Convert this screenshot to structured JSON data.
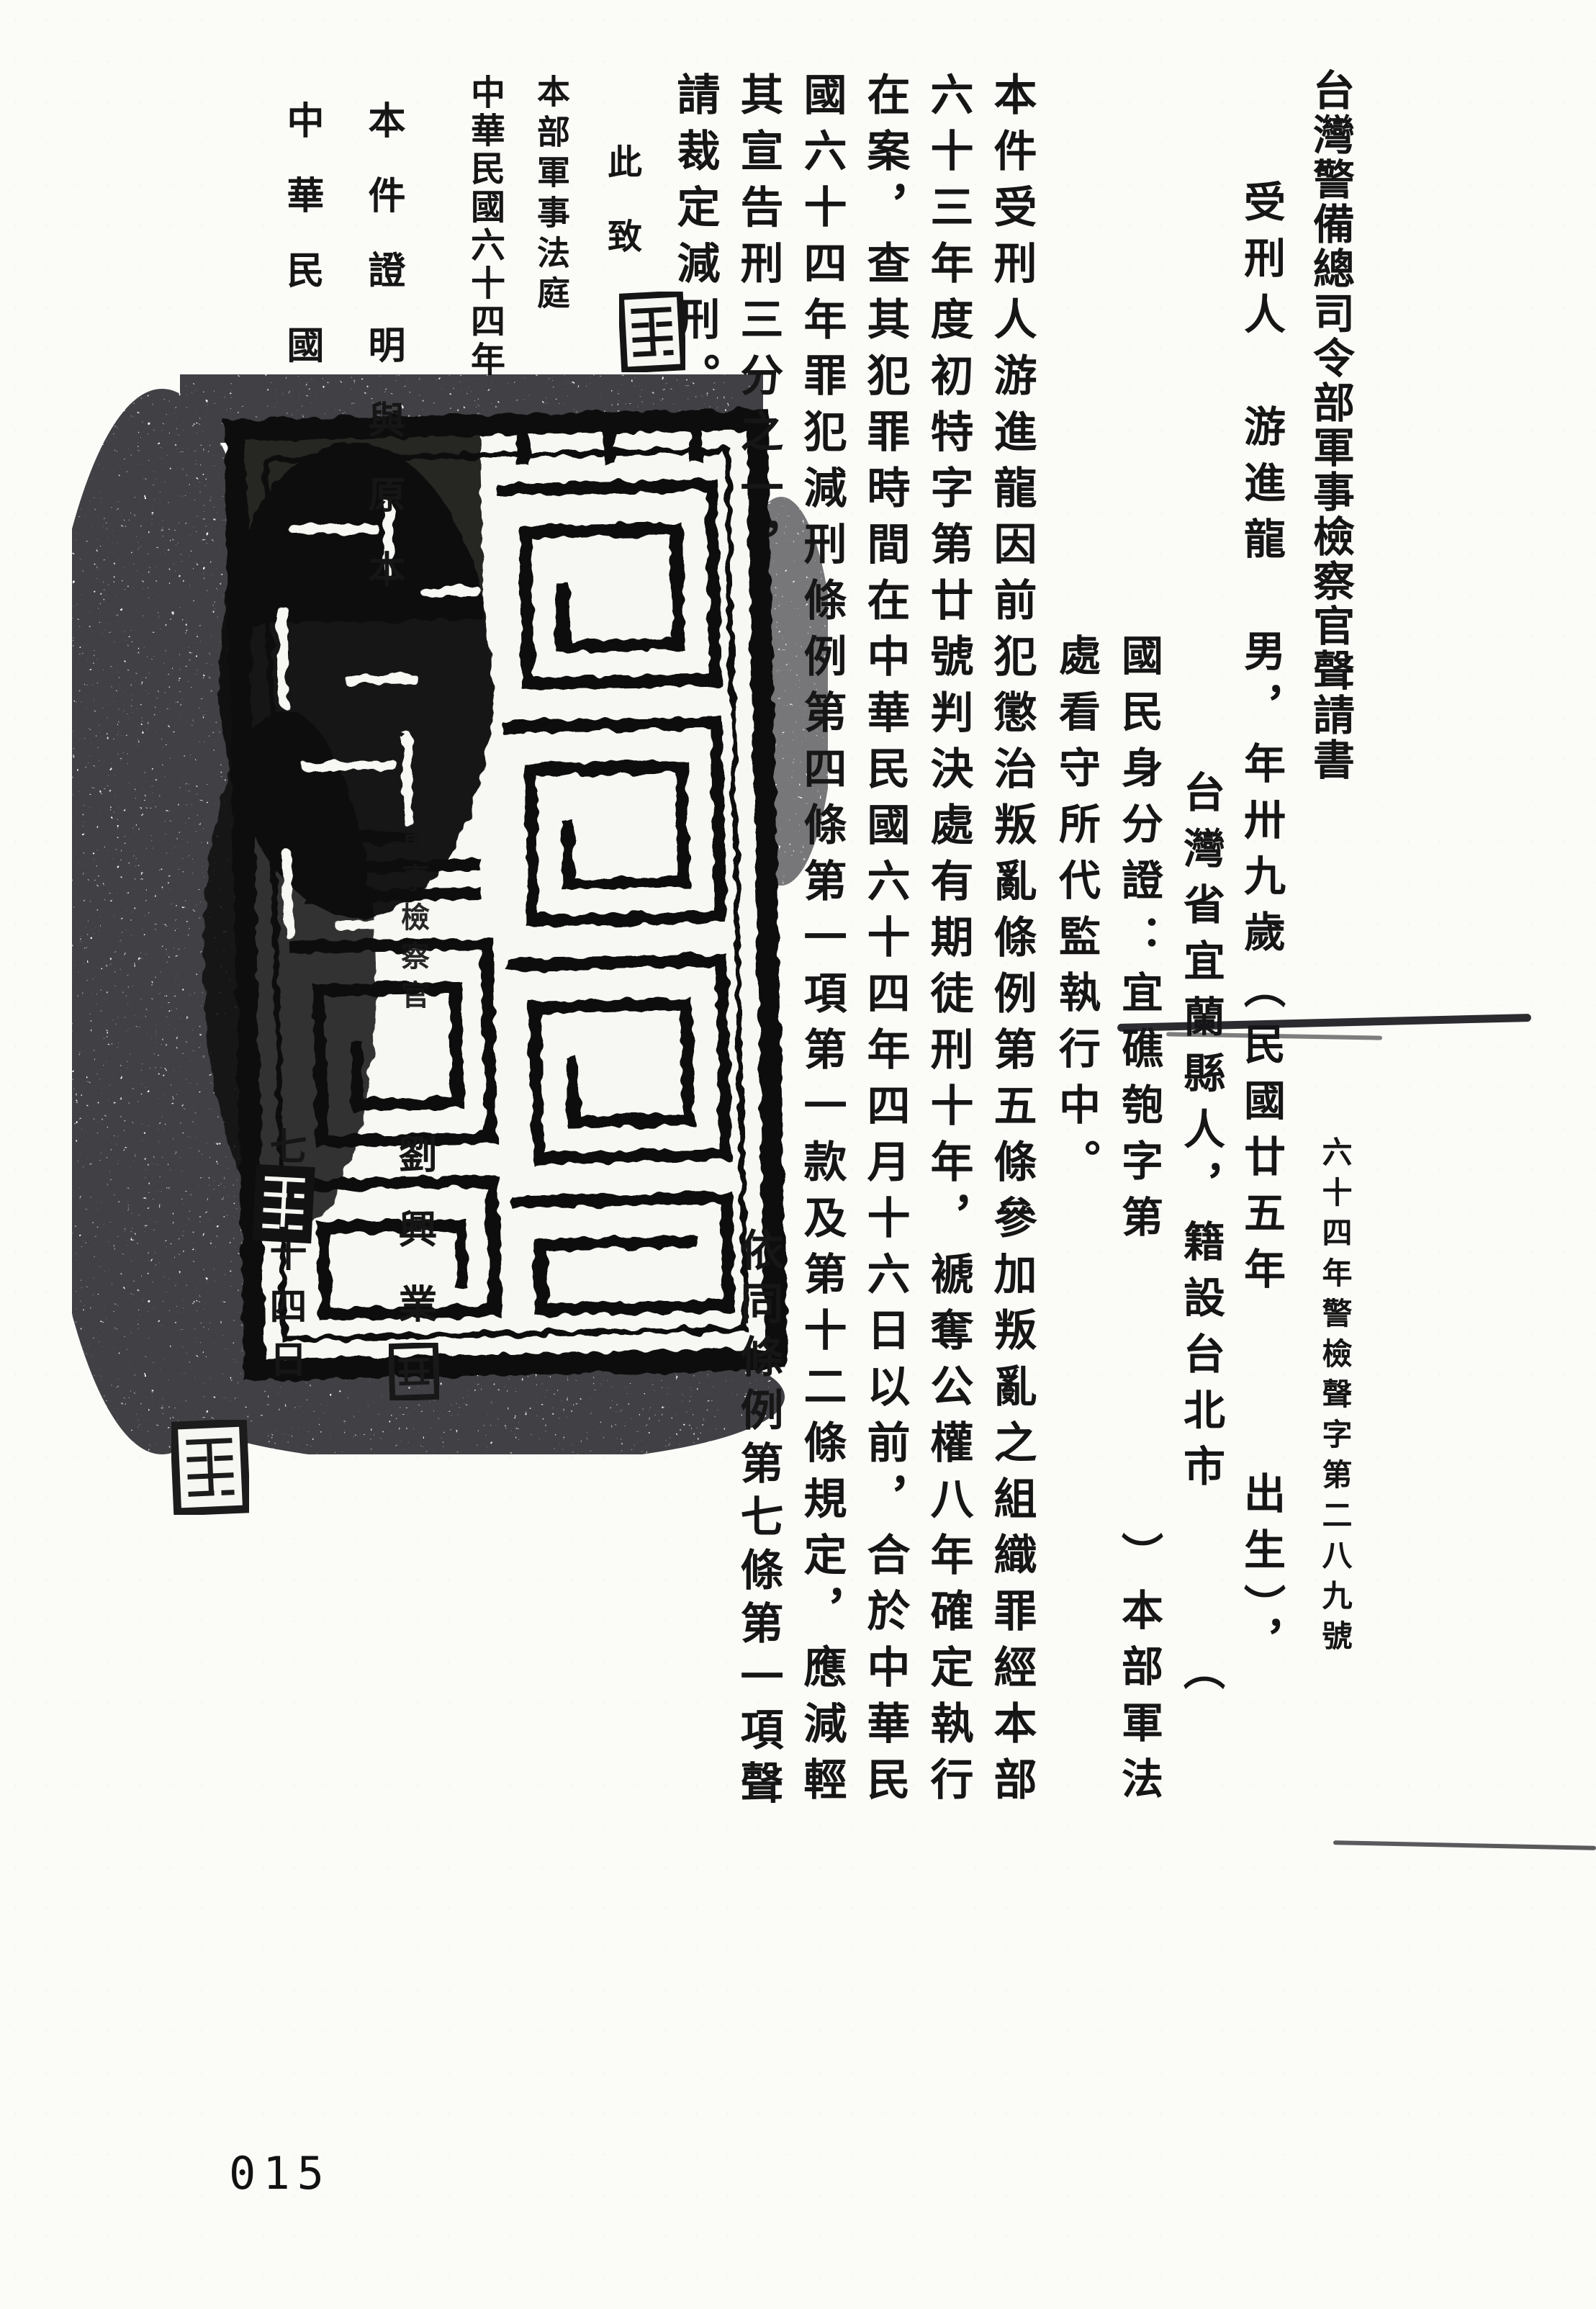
{
  "title": "台灣警備總司令部軍事檢察官聲請書",
  "case_number": "六十四年警檢聲字第二八九號",
  "parties": {
    "line1": "受刑人　游進龍　男，年卅九歲（民國廿五年　　　出生），",
    "line2": "台灣省宜蘭縣人，籍設台北市　　　（",
    "line3": "國民身分證：宜礁匏字第　　　　　）本部軍法",
    "line4": "處看守所代監執行中。"
  },
  "body": {
    "line1": "本件受刑人游進龍因前犯懲治叛亂條例第五條參加叛亂之組織罪經本部",
    "line2": "六十三年度初特字第廿號判決處有期徒刑十年，褫奪公權八年確定執行",
    "line3": "在案，查其犯罪時間在中華民國六十四年四月十六日以前，合於中華民",
    "line4": "國六十四年罪犯減刑條例第四條第一項第一款及第十二條規定，應減輕",
    "line5a": "其宣告刑三分之一，",
    "line5b": "依同條例第七條第一項聲",
    "line6": "請裁定減刑。",
    "salutation": "此致",
    "recipient": "本部軍事法庭",
    "date_line": "中華民國六十四年"
  },
  "signature": {
    "prosecutor_title": "軍事檢察官",
    "prosecutor_name": "劉興業",
    "prosecutor_seal_char": "印"
  },
  "certification": {
    "statement": "本件證明與原本無異",
    "date_prefix": "中華民國",
    "date_suffix": "七月十四日"
  },
  "page": {
    "page_number": "015"
  }
}
